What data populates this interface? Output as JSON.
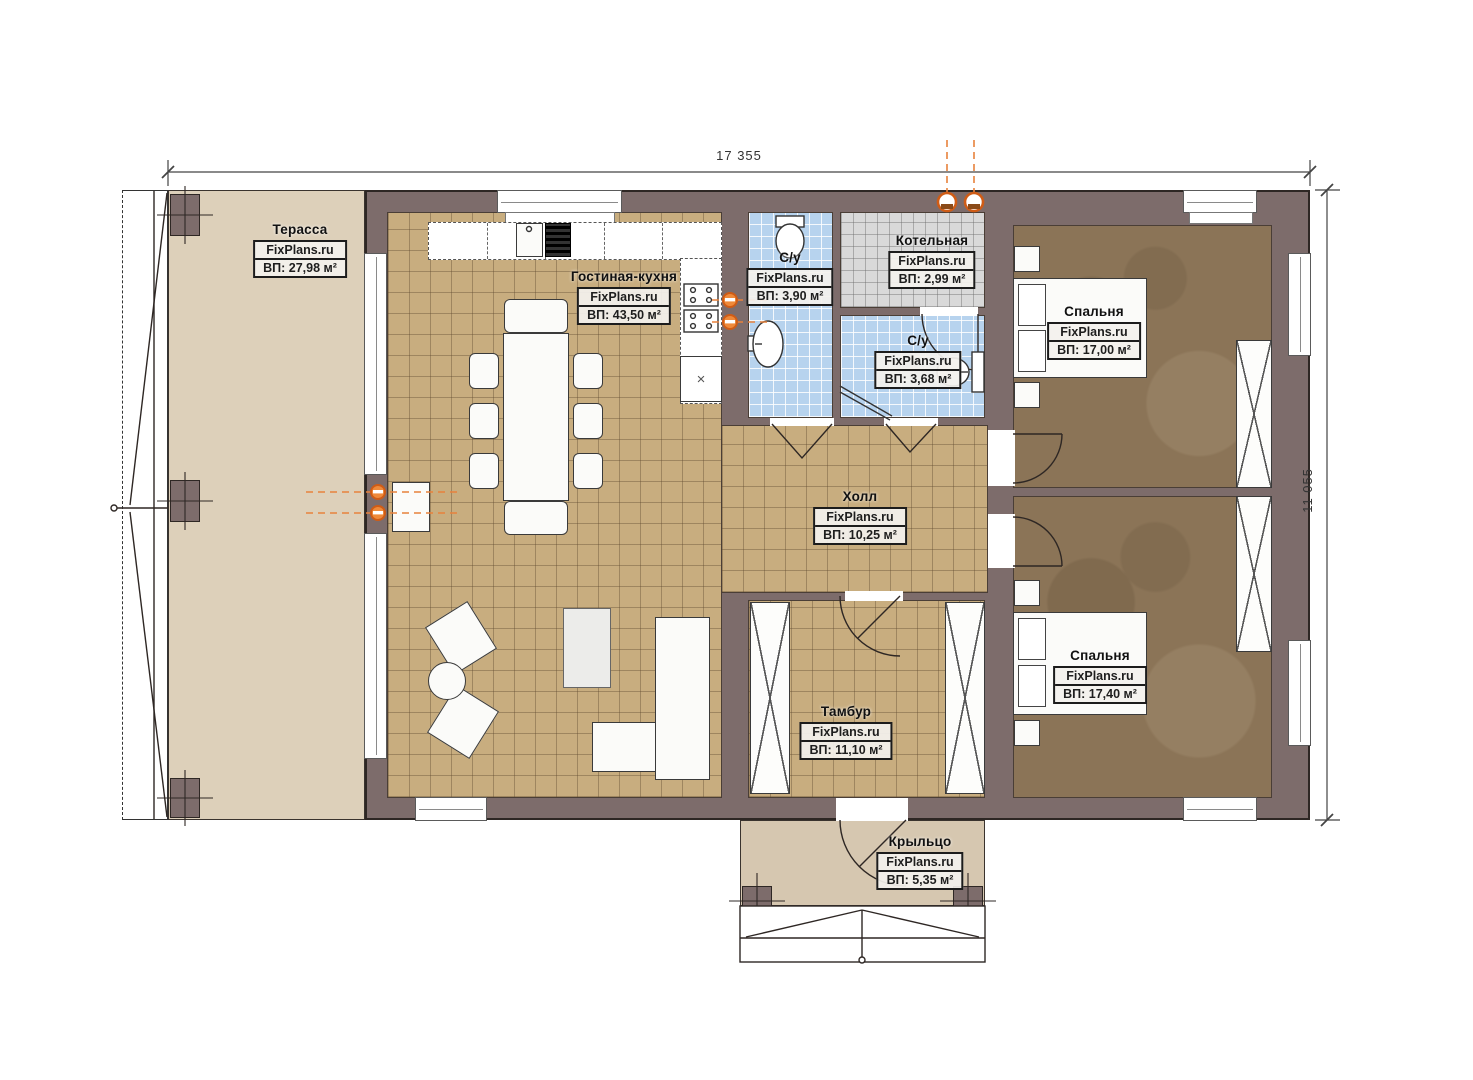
{
  "plan": {
    "watermark": "FixPlans.ru",
    "dimensions": {
      "width": "17 355",
      "height": "11 055"
    },
    "rooms": [
      {
        "key": "terrace",
        "name": "Терасса",
        "site": "FixPlans.ru",
        "area": "ВП: 27,98 м²"
      },
      {
        "key": "living-kitchen",
        "name": "Гостиная-кухня",
        "site": "FixPlans.ru",
        "area": "ВП: 43,50 м²"
      },
      {
        "key": "bathroom-1",
        "name": "С/у",
        "site": "FixPlans.ru",
        "area": "ВП: 3,90 м²"
      },
      {
        "key": "boiler-room",
        "name": "Котельная",
        "site": "FixPlans.ru",
        "area": "ВП: 2,99 м²"
      },
      {
        "key": "bathroom-2",
        "name": "С/у",
        "site": "FixPlans.ru",
        "area": "ВП: 3,68 м²"
      },
      {
        "key": "bedroom-1",
        "name": "Спальня",
        "site": "FixPlans.ru",
        "area": "ВП: 17,00 м²"
      },
      {
        "key": "hall",
        "name": "Холл",
        "site": "FixPlans.ru",
        "area": "ВП: 10,25 м²"
      },
      {
        "key": "bedroom-2",
        "name": "Спальня",
        "site": "FixPlans.ru",
        "area": "ВП: 17,40 м²"
      },
      {
        "key": "vestibule",
        "name": "Тамбур",
        "site": "FixPlans.ru",
        "area": "ВП: 11,10 м²"
      },
      {
        "key": "porch",
        "name": "Крыльцо",
        "site": "FixPlans.ru",
        "area": "ВП: 5,35 м²"
      }
    ],
    "colors": {
      "wall": "#7d6c6b",
      "outline": "#2e2724",
      "terrace_floor": "#ddd0ba",
      "porch_floor": "#d6c7b0",
      "tile_floor": "#c8ad7f",
      "bedroom_floor": "#8b7457",
      "bathroom_floor": "#b7d3ee",
      "boiler_floor": "#d9d9d9",
      "accent_orange": "#d4601c"
    }
  }
}
